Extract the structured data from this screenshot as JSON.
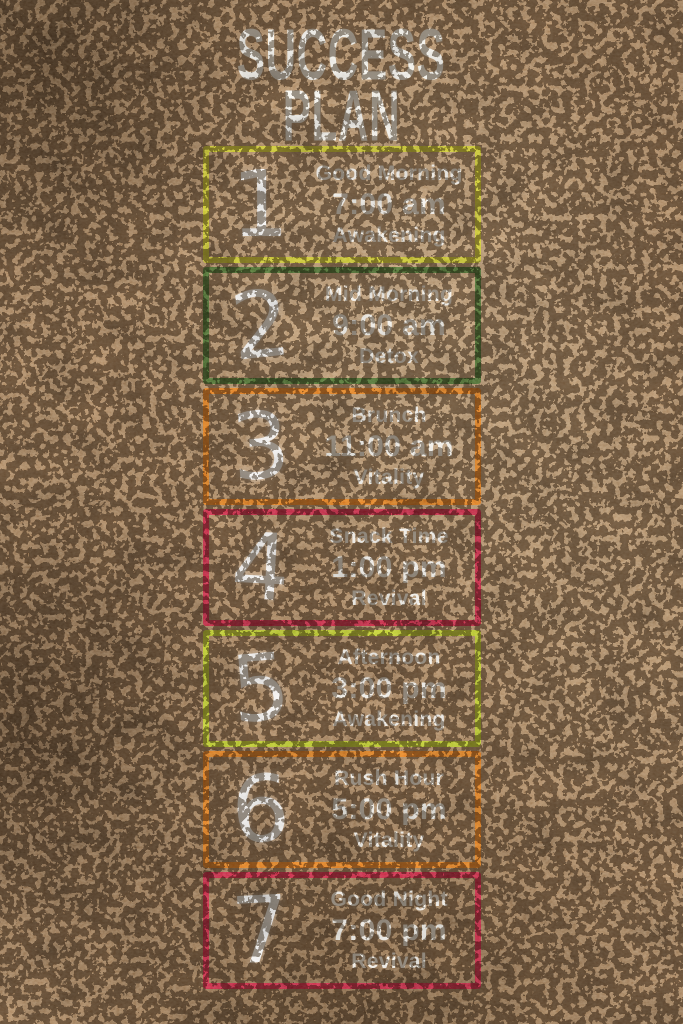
{
  "poster": {
    "title_line1": "SUCCESS",
    "title_line2": "PLAN"
  },
  "colors": {
    "background_brown": "#8a6b4c",
    "text_white": "#fbf8f1",
    "yellow": "#d8d334",
    "green": "#4e7231",
    "orange": "#ee8424",
    "red": "#d02b45",
    "yellow_green": "#c6d52f"
  },
  "steps": [
    {
      "number": "1",
      "label": "Good Morning",
      "time": "7:00 am",
      "category": "Awakening",
      "border_color": "#d8d334"
    },
    {
      "number": "2",
      "label": "Mid Morning",
      "time": "9:00 am",
      "category": "Detox",
      "border_color": "#4e7231"
    },
    {
      "number": "3",
      "label": "Brunch",
      "time": "11:00 am",
      "category": "Vitality",
      "border_color": "#ee8424"
    },
    {
      "number": "4",
      "label": "Snack Time",
      "time": "1:00 pm",
      "category": "Revival",
      "border_color": "#d02b45"
    },
    {
      "number": "5",
      "label": "Afternoon",
      "time": "3:00 pm",
      "category": "Awakening",
      "border_color": "#c6d52f"
    },
    {
      "number": "6",
      "label": "Rush Hour",
      "time": "5:00 pm",
      "category": "Vitality",
      "border_color": "#ee8424"
    },
    {
      "number": "7",
      "label": "Good Night",
      "time": "7:00 pm",
      "category": "Revival",
      "border_color": "#d02b45"
    }
  ]
}
